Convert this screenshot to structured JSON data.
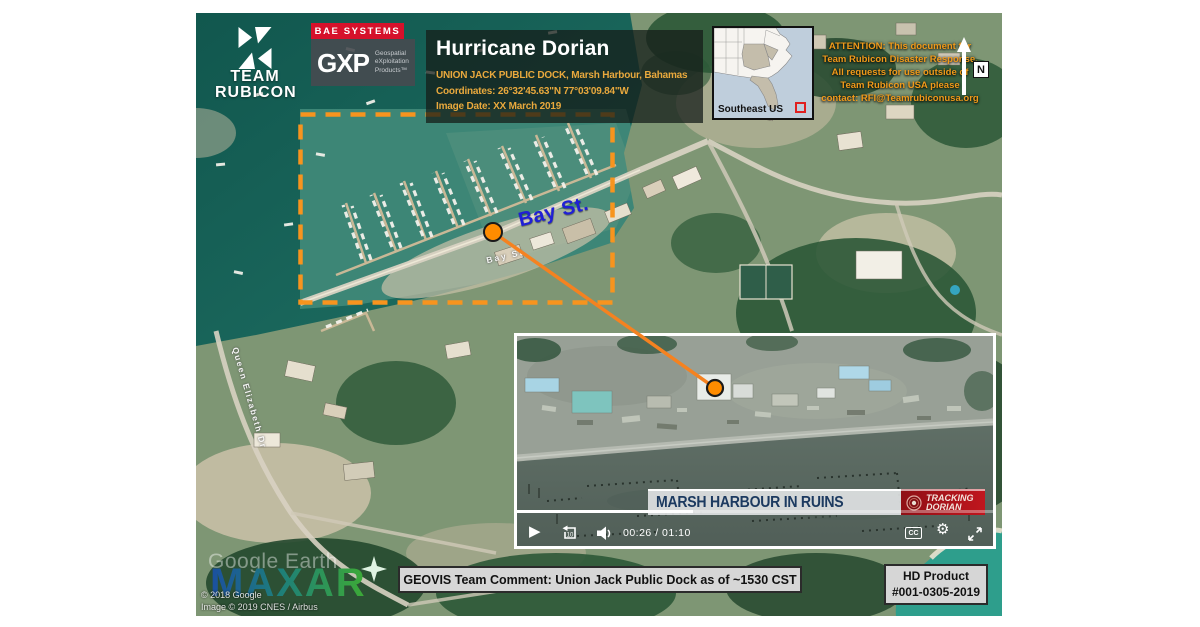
{
  "branding": {
    "team_rubicon": {
      "word1": "TEAM",
      "word2": "RUBICON"
    },
    "bae_label": "BAE SYSTEMS",
    "gxp": {
      "name": "GXP",
      "sub1": "Geospatial",
      "sub2": "eXploitation",
      "sub3": "Products™"
    }
  },
  "title_block": {
    "title": "Hurricane Dorian",
    "location": "UNION JACK PUBLIC DOCK, Marsh Harbour, Bahamas",
    "coordinates": "Coordinates: 26°32'45.63\"N 77°03'09.84\"W",
    "image_date": "Image Date: XX March 2019"
  },
  "inset_map": {
    "label": "Southeast US"
  },
  "attention": {
    "lines": [
      "ATTENTION: This document for",
      "Team Rubicon Disaster Response.",
      "All requests for use outside of",
      "Team Rubicon USA please",
      "contact: RFI@Teamrubiconusa.org"
    ]
  },
  "north_indicator": {
    "label": "N"
  },
  "map_labels": {
    "bay_st_big": "Bay St.",
    "bay_st_small": "Bay St",
    "queen_elizabeth": "Queen Elizabeth Dr"
  },
  "video": {
    "banner": "MARSH HARBOUR IN RUINS",
    "tracking_line1": "TRACKING",
    "tracking_line2": "DORIAN",
    "time": "00:26 / 01:10",
    "cc_label": "CC",
    "play_glyph": "▶",
    "gear_glyph": "⚙",
    "progress_pct": 37
  },
  "footer": {
    "comment": "GEOVIS Team Comment: Union Jack Public Dock as of ~1530 CST",
    "product_line1": "HD Product",
    "product_line2": "#001-0305-2019"
  },
  "watermarks": {
    "google_earth": "Google Earth",
    "maxar": "MAXAR",
    "copyright1": "© 2018 Google",
    "copyright2": "Image © 2019 CNES / Airbus"
  },
  "colors": {
    "accent_orange": "#F7941E",
    "alert_orange": "#F09A1A",
    "title_gold": "#E9A93D",
    "bae_red": "#D6112B",
    "tracking_red": "#B5121B",
    "bay_blue": "#1F1FD6"
  }
}
